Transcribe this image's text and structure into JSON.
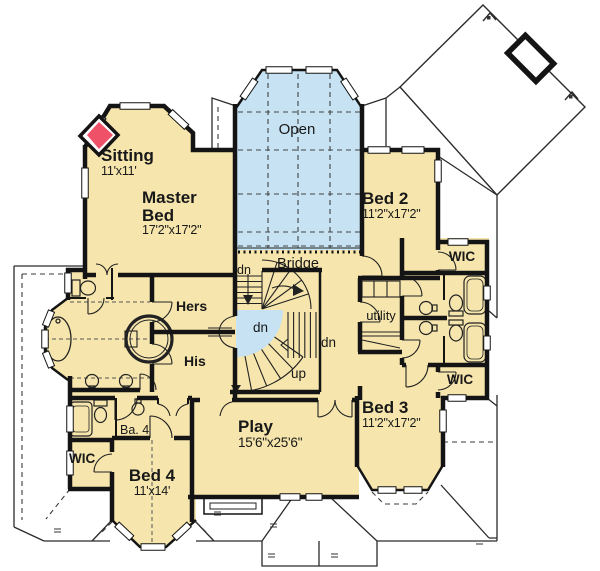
{
  "plan": {
    "rooms": {
      "sitting": {
        "name": "Sitting",
        "dims": "11'x11'"
      },
      "master": {
        "name": "Master Bed",
        "dims": "17'2\"x17'2\""
      },
      "open": {
        "name": "Open"
      },
      "bridge": {
        "name": "Bridge"
      },
      "bed2": {
        "name": "Bed 2",
        "dims": "11'2\"x17'2\""
      },
      "wic_bed2": {
        "name": "WIC"
      },
      "utility": {
        "name": "utility"
      },
      "hers": {
        "name": "Hers"
      },
      "his": {
        "name": "His"
      },
      "bed3": {
        "name": "Bed 3",
        "dims": "11'2\"x17'2\""
      },
      "wic_bed3": {
        "name": "WIC"
      },
      "play": {
        "name": "Play",
        "dims": "15'6\"x25'6\""
      },
      "ba4": {
        "name": "Ba. 4"
      },
      "wic_bed4": {
        "name": "WIC"
      },
      "bed4": {
        "name": "Bed 4",
        "dims": "11'x14'"
      }
    },
    "stairs": {
      "dn_upper": "dn",
      "dn_landing": "dn",
      "dn_lower": "dn",
      "up": "up"
    },
    "colors": {
      "floor": "#f6e6ad",
      "glass": "#c6e2f3",
      "fireplace": "#ee5168",
      "wall": "#141414",
      "line": "#2b2b2b"
    }
  }
}
